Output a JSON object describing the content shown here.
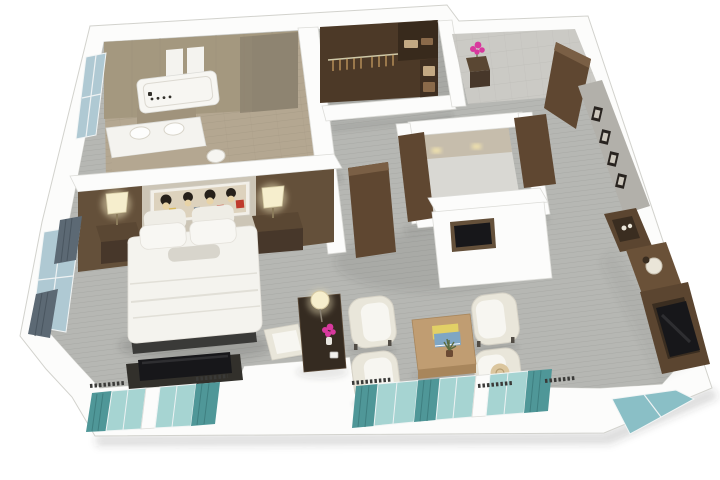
{
  "scene": {
    "kind": "3d-isometric-floor-plan-render",
    "description": "Photorealistic 3D cutaway floor plan of a one-bedroom hotel suite seen from above: bathroom and walk-in closet at top, entry hall top-right, bedroom with king bed at left, living room with four armchairs, coffee table, desk and minibar console at right, window walls with teal curtains along the bottom"
  },
  "palette": {
    "wall_white": "#fcfcfb",
    "wall_face": "#efefec",
    "ext_shadow": "rgba(60,60,60,0.18)",
    "carpet": "#b6b7b3",
    "carpet_line": "#a8a9a5",
    "bath_floor": "#b4a791",
    "bath_wall": "#a4987f",
    "bath_wall_dark": "#8e8471",
    "tile_line": "#9a8f7a",
    "white_panel": "#f4f3ef",
    "tub_white": "#f7f6f2",
    "tub_front": "#a0937c",
    "toilet": "#f6f5f1",
    "closet_wall": "#4c3927",
    "closet_wall_dark": "#382a1c",
    "rod": "#cfc9a8",
    "hanger": "#c49a5f",
    "shelf_wood": "#3f2f21",
    "shelf_item": "#c3a983",
    "shelf_item2": "#8a6a4a",
    "entry_floor": "#cbcac5",
    "entry_line": "#b7b6b1",
    "marble": "#d9d8d3",
    "powder_wall": "#c6bdac",
    "glow_warm": "#f4e5ae",
    "wood_door": "#5f4731",
    "wood_door_edge": "#7a5f45",
    "art_wall": "#b2b0aa",
    "frame_dark": "#28231f",
    "frame_inner": "#cdc8bd",
    "headboard_wood": "#64503a",
    "headboard_fabric": "#ccc5b6",
    "art_bg": "#ddd2bd",
    "art_black": "#26201a",
    "art_cream": "#e8d3a6",
    "art_red": "#bf3a2c",
    "art_yellow": "#d8b85a",
    "art_blue": "#7c8a96",
    "bed_white": "#f4f3ee",
    "bed_fold": "#e1dfd7",
    "bed_base": "#3a3a38",
    "pillow_white": "#f8f7f3",
    "pillow_back": "#efede6",
    "pillow_gray": "#d8d5cc",
    "nightstand_top": "#5a4733",
    "nightstand": "#47372a",
    "lamp_glow": "#f3e8c0",
    "lamp_shade": "#f6eecd",
    "lamp_base": "#8a7a5a",
    "dresser_dark": "#32302b",
    "tv_black": "#17171a",
    "tv_sheen": "rgba(255,255,255,0.10)",
    "wood_desk": "#352b21",
    "chair_cream": "#e9e6da",
    "chair_white": "#f7f6f1",
    "chair_feet": "#514c45",
    "rattan": "#dbc69e",
    "rattan_ring": "#b49d72",
    "wood_table": "#c09d72",
    "wood_table_side": "#a8865c",
    "book_yellow": "#e2d066",
    "book_blue": "#7fa6c4",
    "plant_green": "#5a6b40",
    "plant_pot": "#6b4a33",
    "console_wood": "#5b4530",
    "console_mid": "#6a5138",
    "console_dark": "#3a2d20",
    "tray": "#eae5d8",
    "pink": "#d8399e",
    "teal_curtain": "#4f9798",
    "teal_glass": "#a6d4d2",
    "corner_glass": "#8abfc6",
    "blue_glass": "#afc9d3",
    "gray_curtain": "#5c6974",
    "vent_dark": "#3a3a38",
    "shadow": "rgba(50,50,48,0.10)",
    "shadow_strong": "rgba(50,50,48,0.16)"
  },
  "rooms": [
    {
      "name": "bathroom",
      "items": [
        "bathtub",
        "tub-faucet",
        "double-vanity",
        "toilet",
        "tiled-walls",
        "window"
      ]
    },
    {
      "name": "walk-in-closet",
      "items": [
        "hanging-rod",
        "clothes-hangers",
        "shelving-unit",
        "folded-linens"
      ]
    },
    {
      "name": "entry-hall",
      "items": [
        "entry-door",
        "console-table",
        "flower-vase",
        "gallery-frames"
      ]
    },
    {
      "name": "powder-room",
      "items": [
        "door",
        "marble-floor",
        "accent-lighting"
      ]
    },
    {
      "name": "hallway",
      "items": [
        "bedroom-door",
        "tv-niche-wall"
      ]
    },
    {
      "name": "bedroom",
      "items": [
        "king-bed",
        "pillows",
        "headboard-wall",
        "wall-art",
        "nightstand-left",
        "nightstand-right",
        "table-lamp-left",
        "table-lamp-right",
        "tv-dresser",
        "window-left",
        "windows-bottom"
      ]
    },
    {
      "name": "living-room",
      "items": [
        "writing-desk",
        "desk-chair",
        "desk-lamp",
        "flower-vase",
        "armchair-1",
        "armchair-2",
        "armchair-3",
        "armchair-4",
        "coffee-table",
        "books",
        "plant",
        "minibar-console",
        "television",
        "windows-bottom",
        "corner-window"
      ]
    }
  ]
}
